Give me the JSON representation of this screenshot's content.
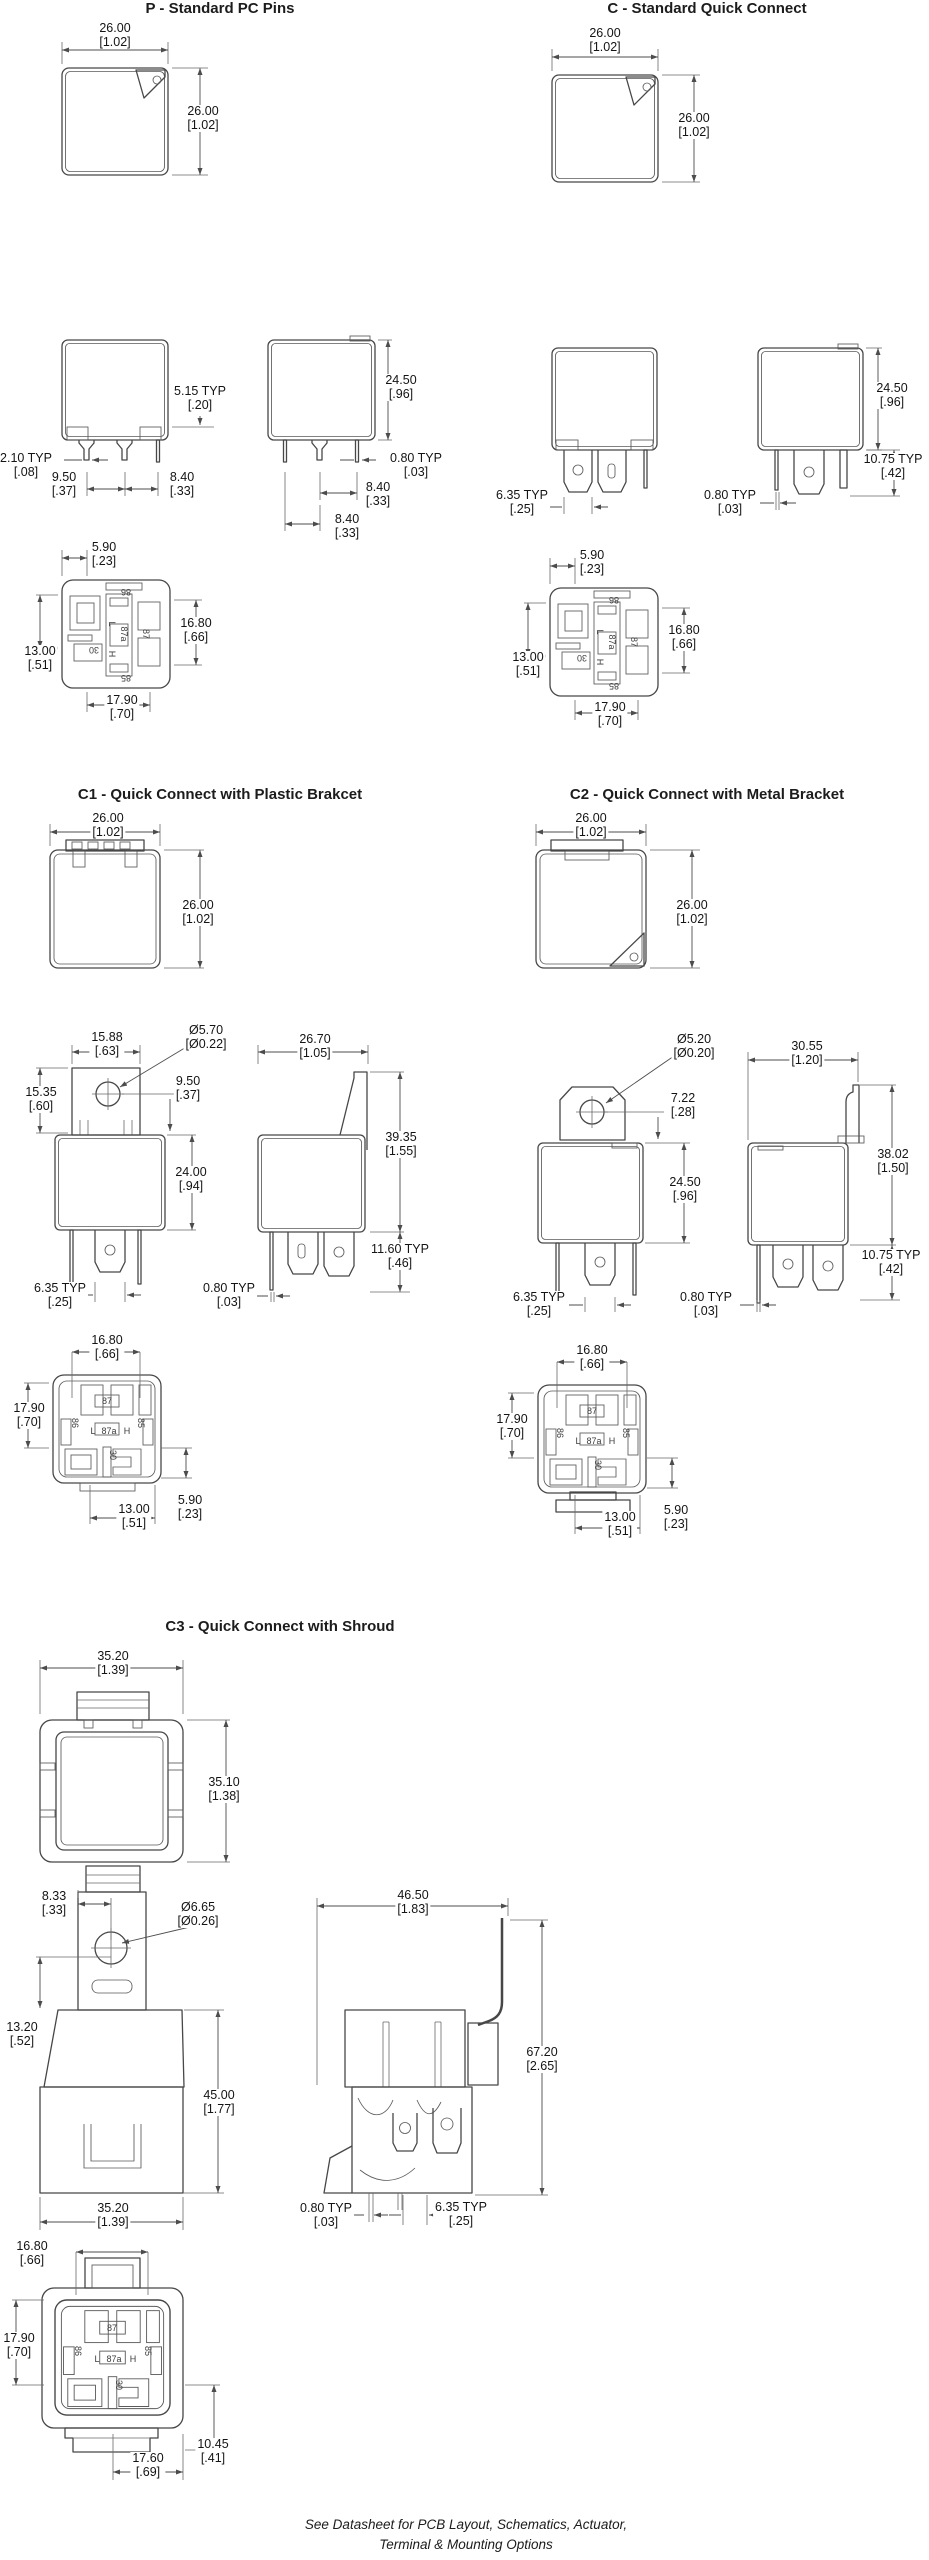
{
  "titles": {
    "p": "P - Standard PC Pins",
    "c": "C - Standard Quick Connect",
    "c1": "C1 - Quick Connect with Plastic Brakcet",
    "c2": "C2 - Quick Connect with Metal Bracket",
    "c3": "C3 - Quick Connect with Shroud"
  },
  "footer": {
    "line1": "See Datasheet for PCB Layout, Schematics, Actuator,",
    "line2": "Terminal & Mounting Options"
  },
  "pins": {
    "n86": "86",
    "n87": "87",
    "n87a": "87a",
    "n85": "85",
    "n30": "30",
    "nL": "L",
    "nH": "H"
  },
  "dims": {
    "p": {
      "top_w": {
        "mm": "26.00",
        "in": "[1.02]"
      },
      "top_h": {
        "mm": "26.00",
        "in": "[1.02]"
      },
      "f1_515": {
        "mm": "5.15 TYP",
        "in": "[.20]"
      },
      "f1_210": {
        "mm": "2.10 TYP",
        "in": "[.08]"
      },
      "f1_950": {
        "mm": "9.50",
        "in": "[.37]"
      },
      "f1_840": {
        "mm": "8.40",
        "in": "[.33]"
      },
      "f2_2450": {
        "mm": "24.50",
        "in": "[.96]"
      },
      "f2_080": {
        "mm": "0.80 TYP",
        "in": "[.03]"
      },
      "f2_840a": {
        "mm": "8.40",
        "in": "[.33]"
      },
      "f2_840b": {
        "mm": "8.40",
        "in": "[.33]"
      },
      "b_590": {
        "mm": "5.90",
        "in": "[.23]"
      },
      "b_1300": {
        "mm": "13.00",
        "in": "[.51]"
      },
      "b_1680": {
        "mm": "16.80",
        "in": "[.66]"
      },
      "b_1790": {
        "mm": "17.90",
        "in": "[.70]"
      }
    },
    "c": {
      "top_w": {
        "mm": "26.00",
        "in": "[1.02]"
      },
      "top_h": {
        "mm": "26.00",
        "in": "[1.02]"
      },
      "f1_635": {
        "mm": "6.35 TYP",
        "in": "[.25]"
      },
      "f2_2450": {
        "mm": "24.50",
        "in": "[.96]"
      },
      "f2_1075": {
        "mm": "10.75 TYP",
        "in": "[.42]"
      },
      "f2_080": {
        "mm": "0.80 TYP",
        "in": "[.03]"
      },
      "b_590": {
        "mm": "5.90",
        "in": "[.23]"
      },
      "b_1300": {
        "mm": "13.00",
        "in": "[.51]"
      },
      "b_1680": {
        "mm": "16.80",
        "in": "[.66]"
      },
      "b_1790": {
        "mm": "17.90",
        "in": "[.70]"
      }
    },
    "c1": {
      "top_w": {
        "mm": "26.00",
        "in": "[1.02]"
      },
      "top_h": {
        "mm": "26.00",
        "in": "[1.02]"
      },
      "m1_1588": {
        "mm": "15.88",
        "in": "[.63]"
      },
      "m1_d570": {
        "mm": "Ø5.70",
        "in": "[Ø0.22]"
      },
      "m1_1535": {
        "mm": "15.35",
        "in": "[.60]"
      },
      "m1_950": {
        "mm": "9.50",
        "in": "[.37]"
      },
      "m1_2400": {
        "mm": "24.00",
        "in": "[.94]"
      },
      "m1_635": {
        "mm": "6.35 TYP",
        "in": "[.25]"
      },
      "m2_2670": {
        "mm": "26.70",
        "in": "[1.05]"
      },
      "m2_3935": {
        "mm": "39.35",
        "in": "[1.55]"
      },
      "m2_1160": {
        "mm": "11.60 TYP",
        "in": "[.46]"
      },
      "m2_080": {
        "mm": "0.80 TYP",
        "in": "[.03]"
      },
      "b_1680": {
        "mm": "16.80",
        "in": "[.66]"
      },
      "b_1790": {
        "mm": "17.90",
        "in": "[.70]"
      },
      "b_1300": {
        "mm": "13.00",
        "in": "[.51]"
      },
      "b_590": {
        "mm": "5.90",
        "in": "[.23]"
      }
    },
    "c2": {
      "top_w": {
        "mm": "26.00",
        "in": "[1.02]"
      },
      "top_h": {
        "mm": "26.00",
        "in": "[1.02]"
      },
      "m1_d520": {
        "mm": "Ø5.20",
        "in": "[Ø0.20]"
      },
      "m1_722": {
        "mm": "7.22",
        "in": "[.28]"
      },
      "m1_2450": {
        "mm": "24.50",
        "in": "[.96]"
      },
      "m1_635": {
        "mm": "6.35 TYP",
        "in": "[.25]"
      },
      "m2_3055": {
        "mm": "30.55",
        "in": "[1.20]"
      },
      "m2_3802": {
        "mm": "38.02",
        "in": "[1.50]"
      },
      "m2_1075": {
        "mm": "10.75 TYP",
        "in": "[.42]"
      },
      "m2_080": {
        "mm": "0.80 TYP",
        "in": "[.03]"
      },
      "b_1680": {
        "mm": "16.80",
        "in": "[.66]"
      },
      "b_1790": {
        "mm": "17.90",
        "in": "[.70]"
      },
      "b_1300": {
        "mm": "13.00",
        "in": "[.51]"
      },
      "b_590": {
        "mm": "5.90",
        "in": "[.23]"
      }
    },
    "c3": {
      "top_w": {
        "mm": "35.20",
        "in": "[1.39]"
      },
      "top_h": {
        "mm": "35.10",
        "in": "[1.38]"
      },
      "m1_833": {
        "mm": "8.33",
        "in": "[.33]"
      },
      "m1_d665": {
        "mm": "Ø6.65",
        "in": "[Ø0.26]"
      },
      "m1_1320": {
        "mm": "13.20",
        "in": "[.52]"
      },
      "m1_4500": {
        "mm": "45.00",
        "in": "[1.77]"
      },
      "m1_3520": {
        "mm": "35.20",
        "in": "[1.39]"
      },
      "m2_4650": {
        "mm": "46.50",
        "in": "[1.83]"
      },
      "m2_6720": {
        "mm": "67.20",
        "in": "[2.65]"
      },
      "m2_080": {
        "mm": "0.80 TYP",
        "in": "[.03]"
      },
      "m2_635": {
        "mm": "6.35 TYP",
        "in": "[.25]"
      },
      "b_1680": {
        "mm": "16.80",
        "in": "[.66]"
      },
      "b_1790": {
        "mm": "17.90",
        "in": "[.70]"
      },
      "b_1760": {
        "mm": "17.60",
        "in": "[.69]"
      },
      "b_1045": {
        "mm": "10.45",
        "in": "[.41]"
      }
    }
  }
}
